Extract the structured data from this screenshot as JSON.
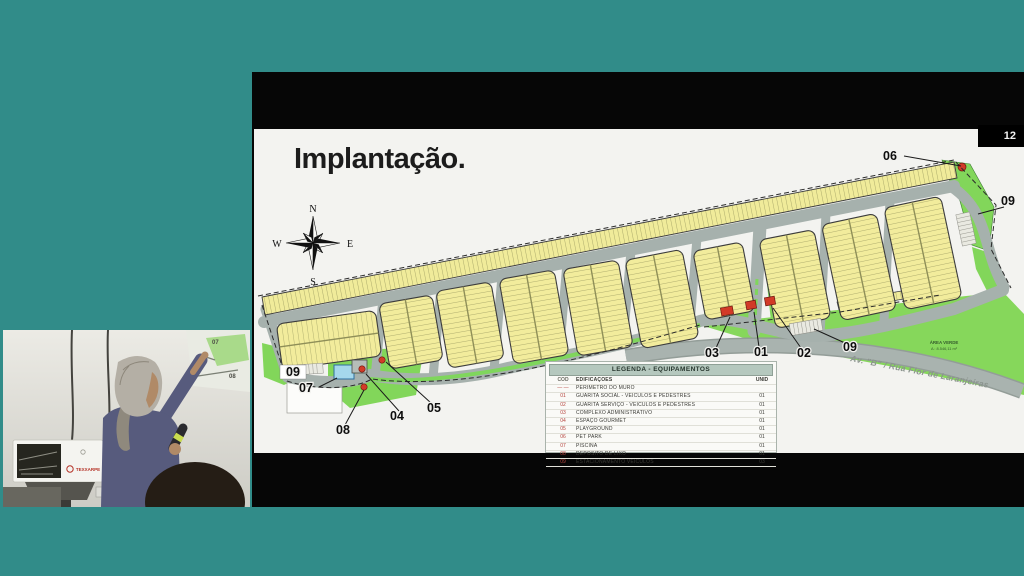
{
  "page_number": "12",
  "slide": {
    "title": "Implantação.",
    "compass": {
      "n": "N",
      "e": "E",
      "s": "S",
      "w": "W"
    },
    "map": {
      "road_label": "Av. \"B\" / Rua Flor de Laranjeiras",
      "green_area_label": {
        "line1": "ÁREA VERDE",
        "line2": "A : 8.546,11 m²"
      },
      "callouts": [
        {
          "label": "06",
          "x": 636,
          "y": 31,
          "x1": 650,
          "y1": 27,
          "x2": 707,
          "y2": 37,
          "boxed": false
        },
        {
          "label": "09",
          "x": 754,
          "y": 76,
          "x1": 750,
          "y1": 78,
          "x2": 724,
          "y2": 85,
          "boxed": false
        },
        {
          "label": "03",
          "x": 458,
          "y": 228,
          "x1": 462,
          "y1": 219,
          "x2": 476,
          "y2": 188,
          "boxed": false
        },
        {
          "label": "01",
          "x": 507,
          "y": 227,
          "x1": 505,
          "y1": 218,
          "x2": 500,
          "y2": 183,
          "boxed": false
        },
        {
          "label": "02",
          "x": 550,
          "y": 228,
          "x1": 547,
          "y1": 219,
          "x2": 519,
          "y2": 179,
          "boxed": false
        },
        {
          "label": "09",
          "x": 596,
          "y": 222,
          "x1": 591,
          "y1": 214,
          "x2": 560,
          "y2": 200,
          "boxed": false
        },
        {
          "label": "07",
          "x": 52,
          "y": 263,
          "x1": 65,
          "y1": 258,
          "x2": 83,
          "y2": 249,
          "boxed": false
        },
        {
          "label": "09",
          "x": 39,
          "y": 247,
          "boxed": true
        },
        {
          "label": "08",
          "x": 89,
          "y": 305,
          "x1": 91,
          "y1": 296,
          "x2": 110,
          "y2": 261,
          "boxed": false
        },
        {
          "label": "04",
          "x": 143,
          "y": 291,
          "x1": 145,
          "y1": 282,
          "x2": 112,
          "y2": 245,
          "boxed": false
        },
        {
          "label": "05",
          "x": 180,
          "y": 283,
          "x1": 177,
          "y1": 274,
          "x2": 132,
          "y2": 233,
          "boxed": false
        }
      ]
    },
    "legend": {
      "title": "LEGENDA - EQUIPAMENTOS",
      "columns": [
        "CÓD",
        "EDIFICAÇÕES",
        "UNID"
      ],
      "rows": [
        {
          "cod": "— —",
          "name": "PERÍMETRO DO MURO",
          "unid": ""
        },
        {
          "cod": "01",
          "name": "GUARITA SOCIAL - VEÍCULOS E PEDESTRES",
          "unid": "01"
        },
        {
          "cod": "02",
          "name": "GUARITA SERVIÇO - VEÍCULOS E PEDESTRES",
          "unid": "01"
        },
        {
          "cod": "03",
          "name": "COMPLEXO ADMINISTRATIVO",
          "unid": "01"
        },
        {
          "cod": "04",
          "name": "ESPAÇO GOURMET",
          "unid": "01"
        },
        {
          "cod": "05",
          "name": "PLAYGROUND",
          "unid": "01"
        },
        {
          "cod": "06",
          "name": "PET PARK",
          "unid": "01"
        },
        {
          "cod": "07",
          "name": "PISCINA",
          "unid": "01"
        },
        {
          "cod": "08",
          "name": "DEPÓSITO DE LIXO",
          "unid": "01"
        },
        {
          "cod": "09",
          "name": "ESTACIONAMENTO VEÍCULOS",
          "unid": "03"
        }
      ]
    }
  },
  "webcam": {
    "projected_labels": [
      "07",
      "08"
    ],
    "device_label": "TEXXARPE"
  },
  "colors": {
    "background_teal": "#318c89",
    "screen_black": "#060606",
    "slide_white": "#f3f3f0",
    "lot_yellow": "#f2ec9c",
    "road_gray": "#a6b1ad",
    "green_area": "#82d65a",
    "marker_red": "#d23a28",
    "legend_header": "#b5c8be",
    "legend_code_red": "#b5433c"
  }
}
